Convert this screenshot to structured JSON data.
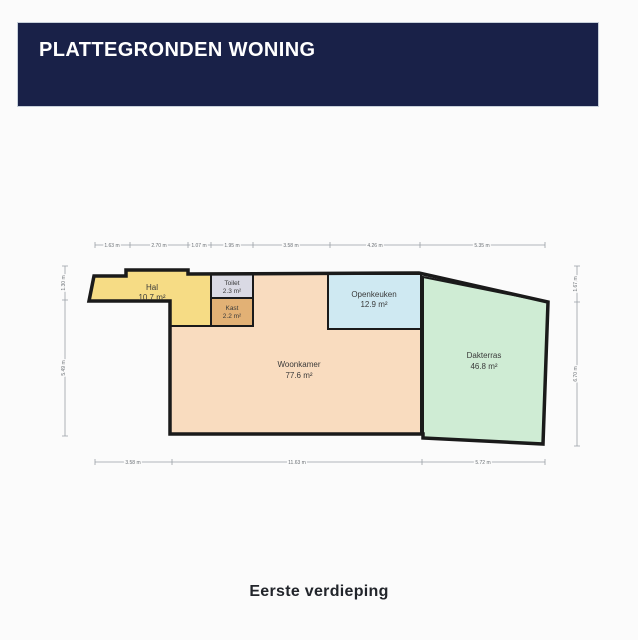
{
  "header": {
    "title": "PLATTEGRONDEN WONING"
  },
  "caption": "Eerste verdieping",
  "colors": {
    "header_bg": "#192148",
    "header_text": "#ffffff",
    "wall": "#1a1a1a",
    "dimension_line": "#9aa0a6",
    "page_bg": "#fbfbfb"
  },
  "floorplan": {
    "rooms": [
      {
        "name": "Hal",
        "area": "10.7 m²",
        "color": "#f6dc85"
      },
      {
        "name": "Toilet",
        "area": "2.3 m²",
        "color": "#dadae4"
      },
      {
        "name": "Kast",
        "area": "2.2 m²",
        "color": "#e2b175"
      },
      {
        "name": "Woonkamer",
        "area": "77.6 m²",
        "color": "#f9dcbf"
      },
      {
        "name": "Openkeuken",
        "area": "12.9 m²",
        "color": "#cfe9f2"
      },
      {
        "name": "Dakterras",
        "area": "46.8 m²",
        "color": "#cfecd4"
      }
    ],
    "dimensions": {
      "top": [
        "1.63 m",
        "2.70 m",
        "1.07 m",
        "1.95 m",
        "3.58 m",
        "4.26 m",
        "5.35 m"
      ],
      "bottom": [
        "3.58 m",
        "11.63 m",
        "5.72 m"
      ],
      "left": [
        "1.30 m",
        "5.49 m"
      ],
      "right": [
        "1.67 m",
        "6.70 m"
      ]
    }
  }
}
